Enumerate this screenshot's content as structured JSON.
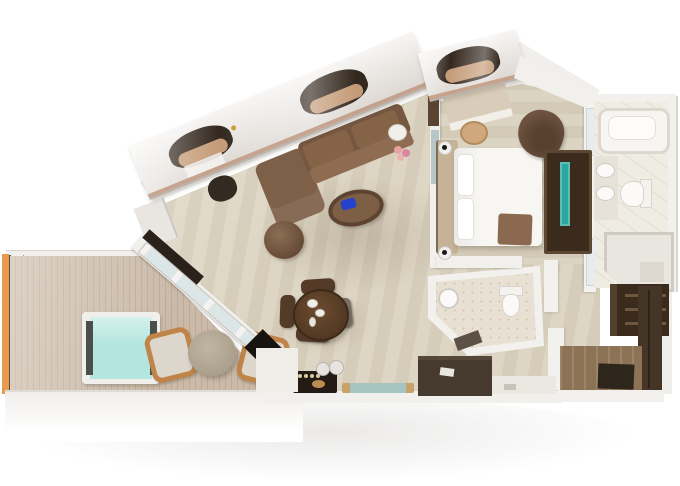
{
  "scene": {
    "kind": "3d-floor-plan-render",
    "subject": "Bird's-eye 3D rendering of a suite floor plan: balcony with hot tub, living-dining room, bedroom, master bathroom, powder room and entry with walk-in closets",
    "background_color": "#ffffff"
  },
  "palette": {
    "floor_wood_light": "#dbd2c0",
    "deck_wood": "#c9b8a6",
    "hot_tub_water": "#b2e6de",
    "accent_orange": "#e89a4e",
    "chair_frame_tan": "#c08448",
    "stone_table": "#b3a995",
    "sofa_brown": "#7e5f48",
    "sofa_back_brown": "#765741",
    "coffee_table_brown": "#7d5f45",
    "cobalt_accent": "#2442cc",
    "dining_wood": "#5d4026",
    "bed_white": "#f8f6f2",
    "headboard_tan": "#c6b296",
    "throw_brown": "#8a6950",
    "tv_teal": "#2aa79e",
    "awning_dark": "#33281e",
    "cushion_tan": "#c49b77",
    "closet_wood_dark": "#3a2b1d",
    "wardrobe_wood": "#443527",
    "entry_wood": "#8d7356",
    "marble_light": "#efece4",
    "powder_marble": "#e8e1d3",
    "wall_white": "#f2f0ed"
  },
  "rooms": [
    {
      "name": "balcony",
      "features": [
        "vertical plank decking",
        "square hot tub",
        "round stone table",
        "two tan-framed chairs",
        "glass balustrade with orange trim"
      ]
    },
    {
      "name": "living-dining-room",
      "features": [
        "l-shaped brown sofa",
        "oval coffee table with cobalt object",
        "round swivel chair",
        "dining table set for four",
        "desk with chair at window",
        "dark bar console with bottles",
        "glass display case",
        "side table with pink flowers"
      ]
    },
    {
      "name": "bedroom",
      "features": [
        "double bed with white duvet",
        "tan headboard",
        "two bedside lamps",
        "vanity desk with stool",
        "brown lounge chair",
        "dark tv console with teal screen"
      ]
    },
    {
      "name": "master-bathroom",
      "features": [
        "bathtub",
        "double-sink vanity",
        "toilet",
        "walk-in shower with chamfered glass corner",
        "marble floor"
      ]
    },
    {
      "name": "powder-room",
      "features": [
        "round sink",
        "toilet",
        "speckled marble floor",
        "angled corner wall"
      ]
    },
    {
      "name": "entry-walk-in-closet",
      "features": [
        "shelved closet",
        "tall dark wardrobes",
        "wood entry floor",
        "dark door mat"
      ]
    }
  ],
  "architecture": {
    "window_bays": 3,
    "window_wall": "slanted glazed wall with dark awning openings",
    "balcony_door": "diagonal sliding glass door with dark track"
  }
}
